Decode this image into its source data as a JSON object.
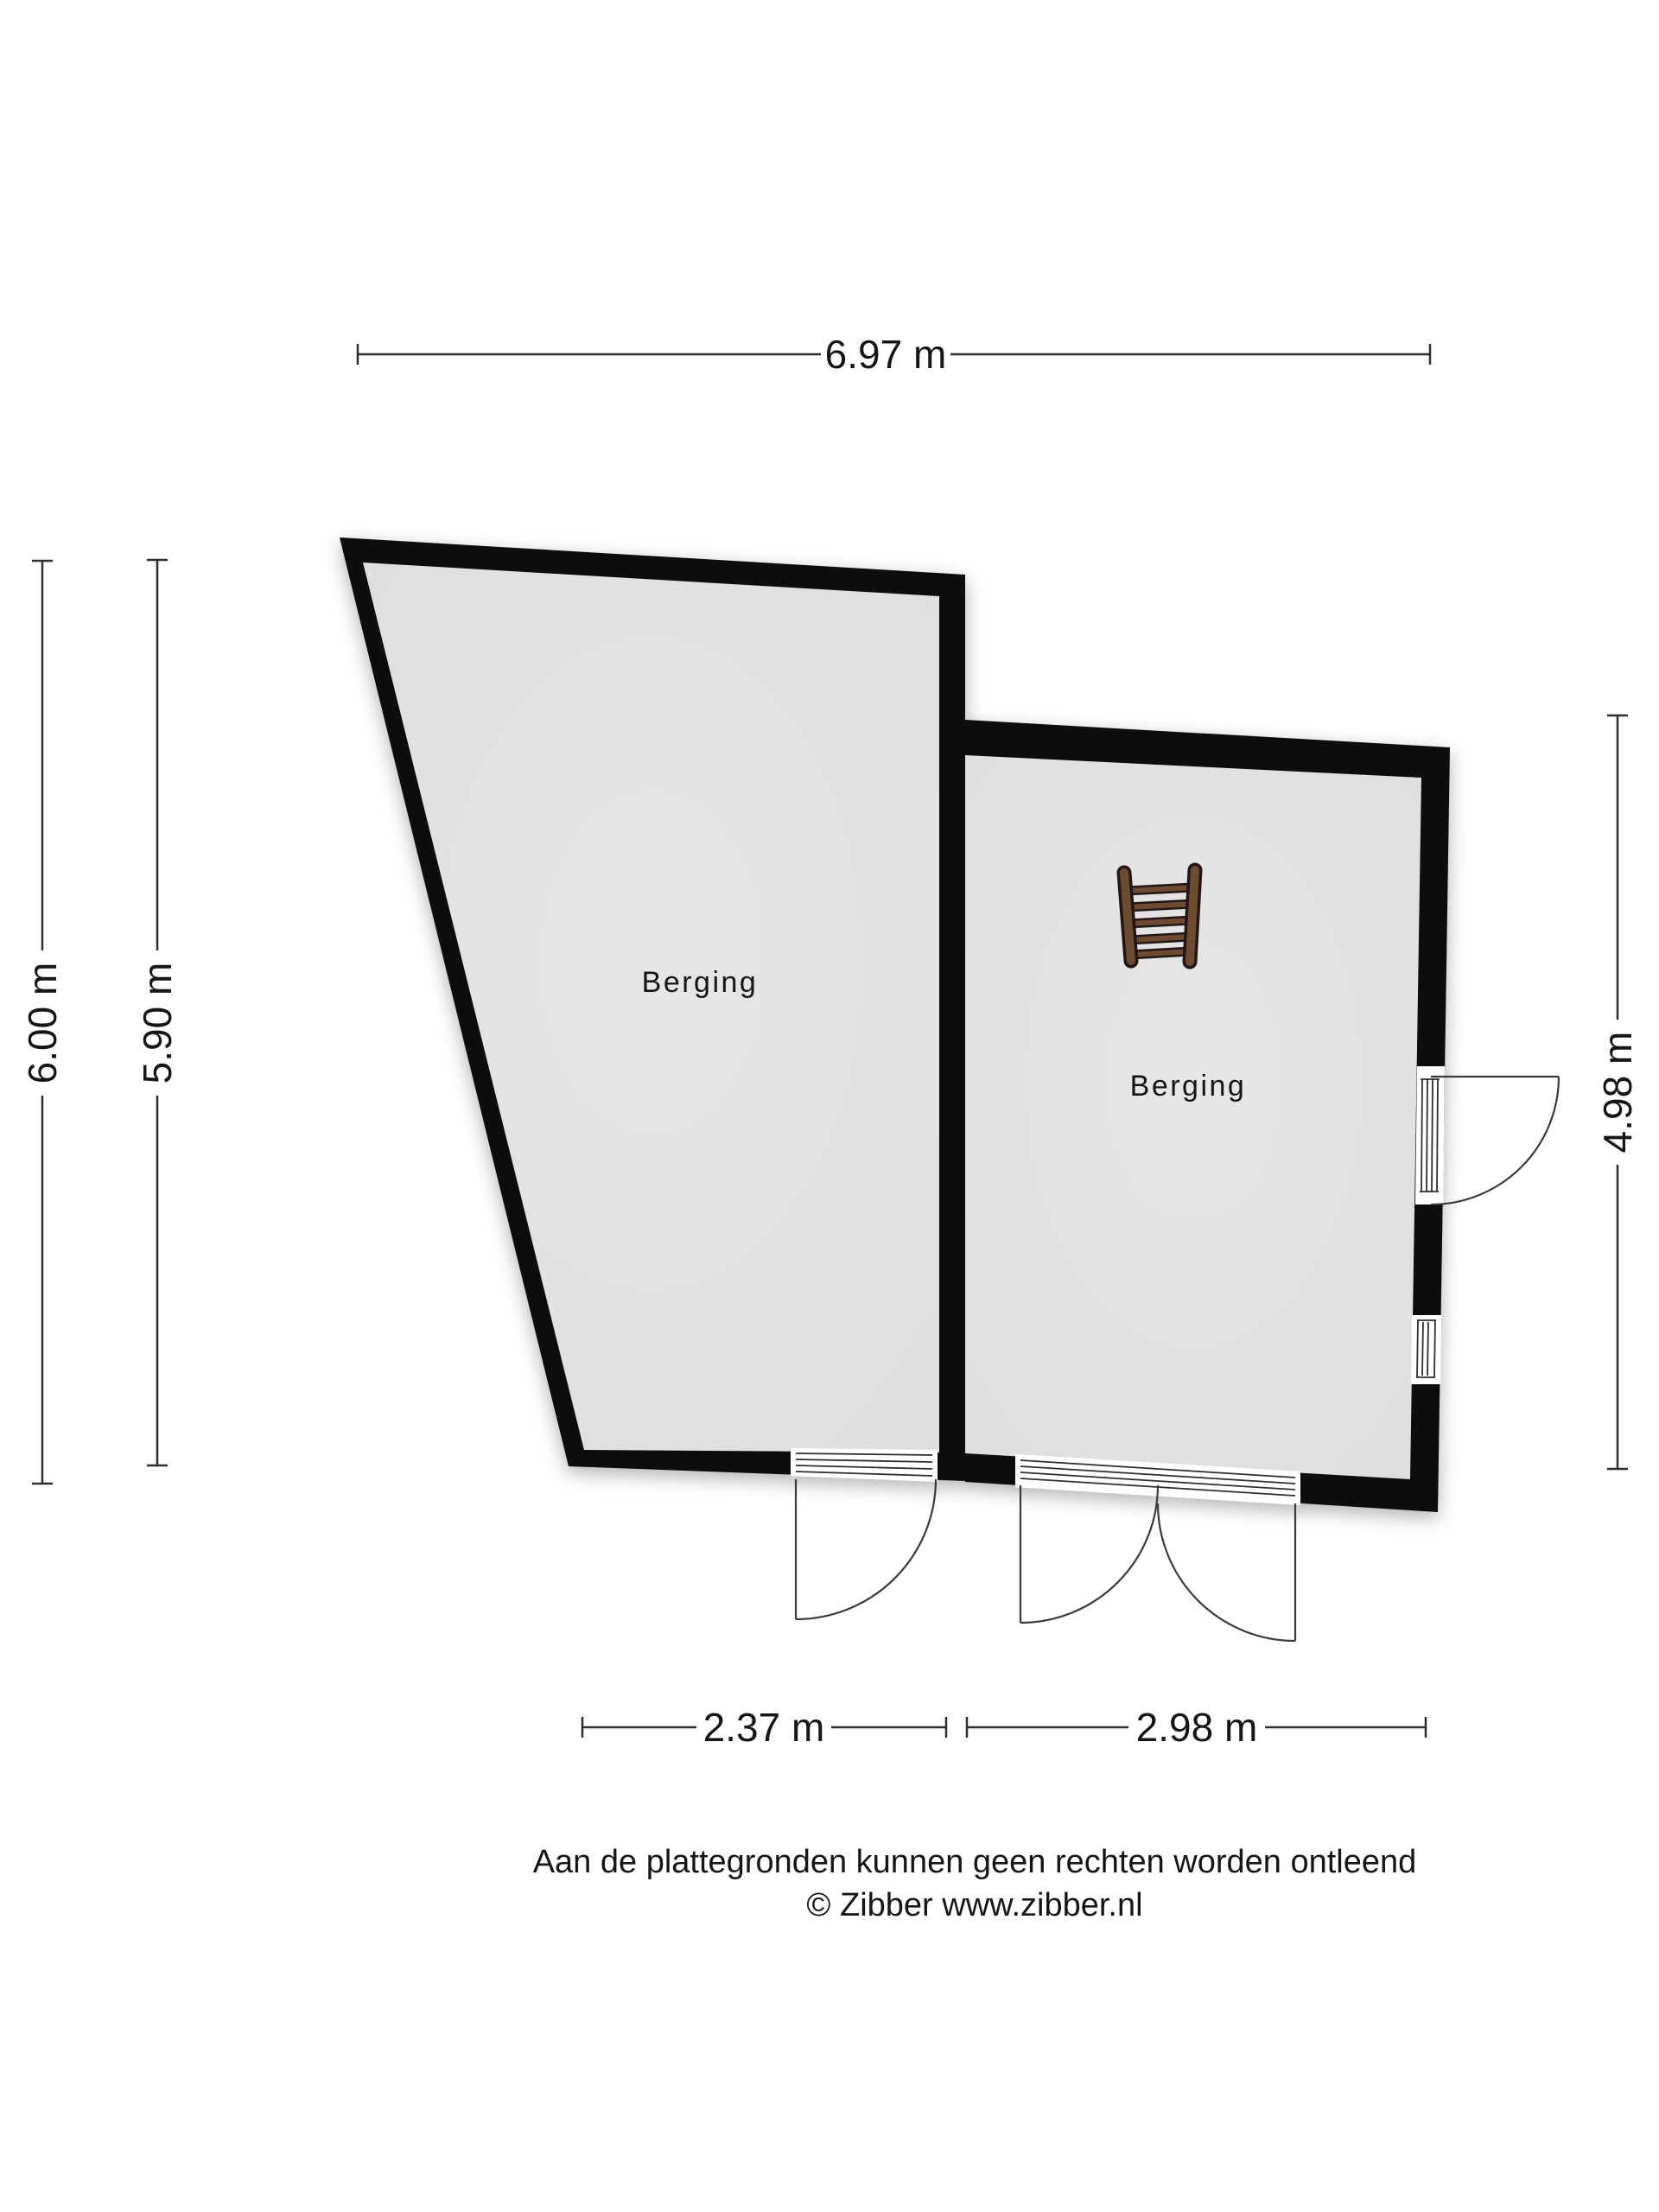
{
  "plan": {
    "rooms": [
      {
        "label": "Berging"
      },
      {
        "label": "Berging"
      }
    ],
    "dimensions": {
      "top": {
        "label": "6.97 m"
      },
      "left_outer": {
        "label": "6.00 m"
      },
      "left_inner": {
        "label": "5.90 m"
      },
      "right": {
        "label": "4.98 m"
      },
      "bottom_left": {
        "label": "2.37 m"
      },
      "bottom_right": {
        "label": "2.98 m"
      }
    },
    "furniture": [
      {
        "icon": "ladder-icon"
      }
    ],
    "footer": {
      "disclaimer": "Aan de plattegronden kunnen geen rechten worden ontleend",
      "copyright": "© Zibber www.zibber.nl"
    },
    "colors": {
      "wall": "#0b0b0b",
      "floor": "#e3e3e3",
      "ladder_wood": "#6d4b33",
      "ladder_outline": "#241712",
      "line": "#2e2e2e"
    }
  }
}
